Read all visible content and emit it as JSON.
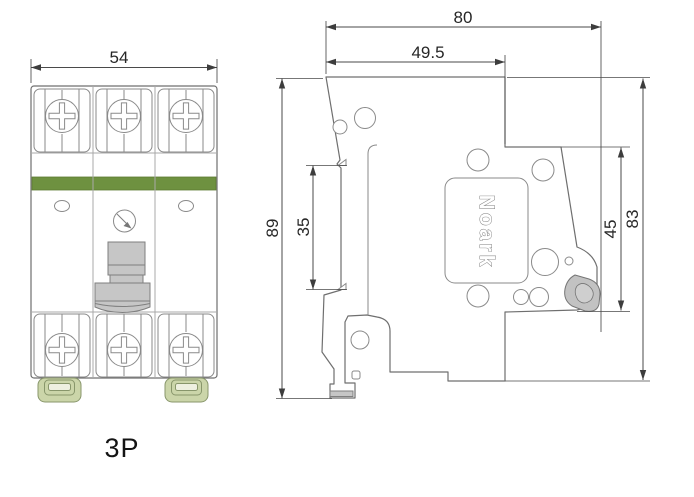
{
  "drawing": {
    "front_view": {
      "width_dim": "54",
      "pole_label": "3P"
    },
    "side_view": {
      "total_depth_dim": "80",
      "upper_depth_dim": "49.5",
      "total_height_dim": "89",
      "front_section_dim": "35",
      "din_section_dim": "45",
      "case_height_dim": "83",
      "brand": "Noark"
    },
    "colors": {
      "band_green": "#6e9140",
      "clamp_green": "#cbd5a9",
      "clamp_inner": "#eef0e0",
      "handle_gray": "#c6c6c6",
      "lever_gray": "#c2c2c2",
      "outline_gray": "#6f6f6f",
      "dim_gray": "#3d3d3d"
    }
  }
}
